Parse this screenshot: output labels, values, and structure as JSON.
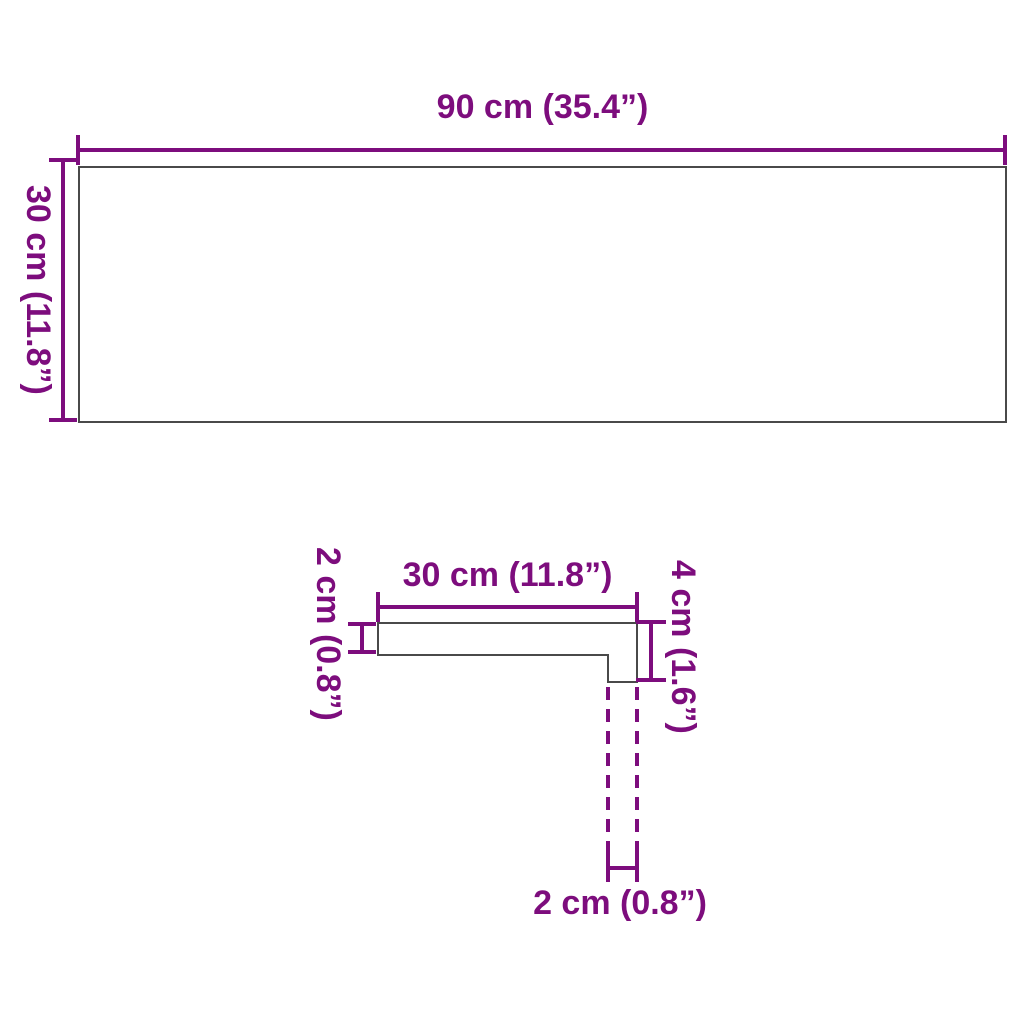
{
  "colors": {
    "dimension_lines_and_text": "#7d0d7d",
    "shape_outline": "#4a4a4a",
    "background": "#ffffff"
  },
  "top_view": {
    "width_label": "90 cm (35.4”)",
    "height_label": "30 cm (11.8”)"
  },
  "profile_view": {
    "depth_label": "30 cm (11.8”)",
    "thickness_label": "2 cm (0.8”)",
    "total_height_label": "4 cm (1.6”)",
    "lip_width_label": "2 cm (0.8”)"
  }
}
